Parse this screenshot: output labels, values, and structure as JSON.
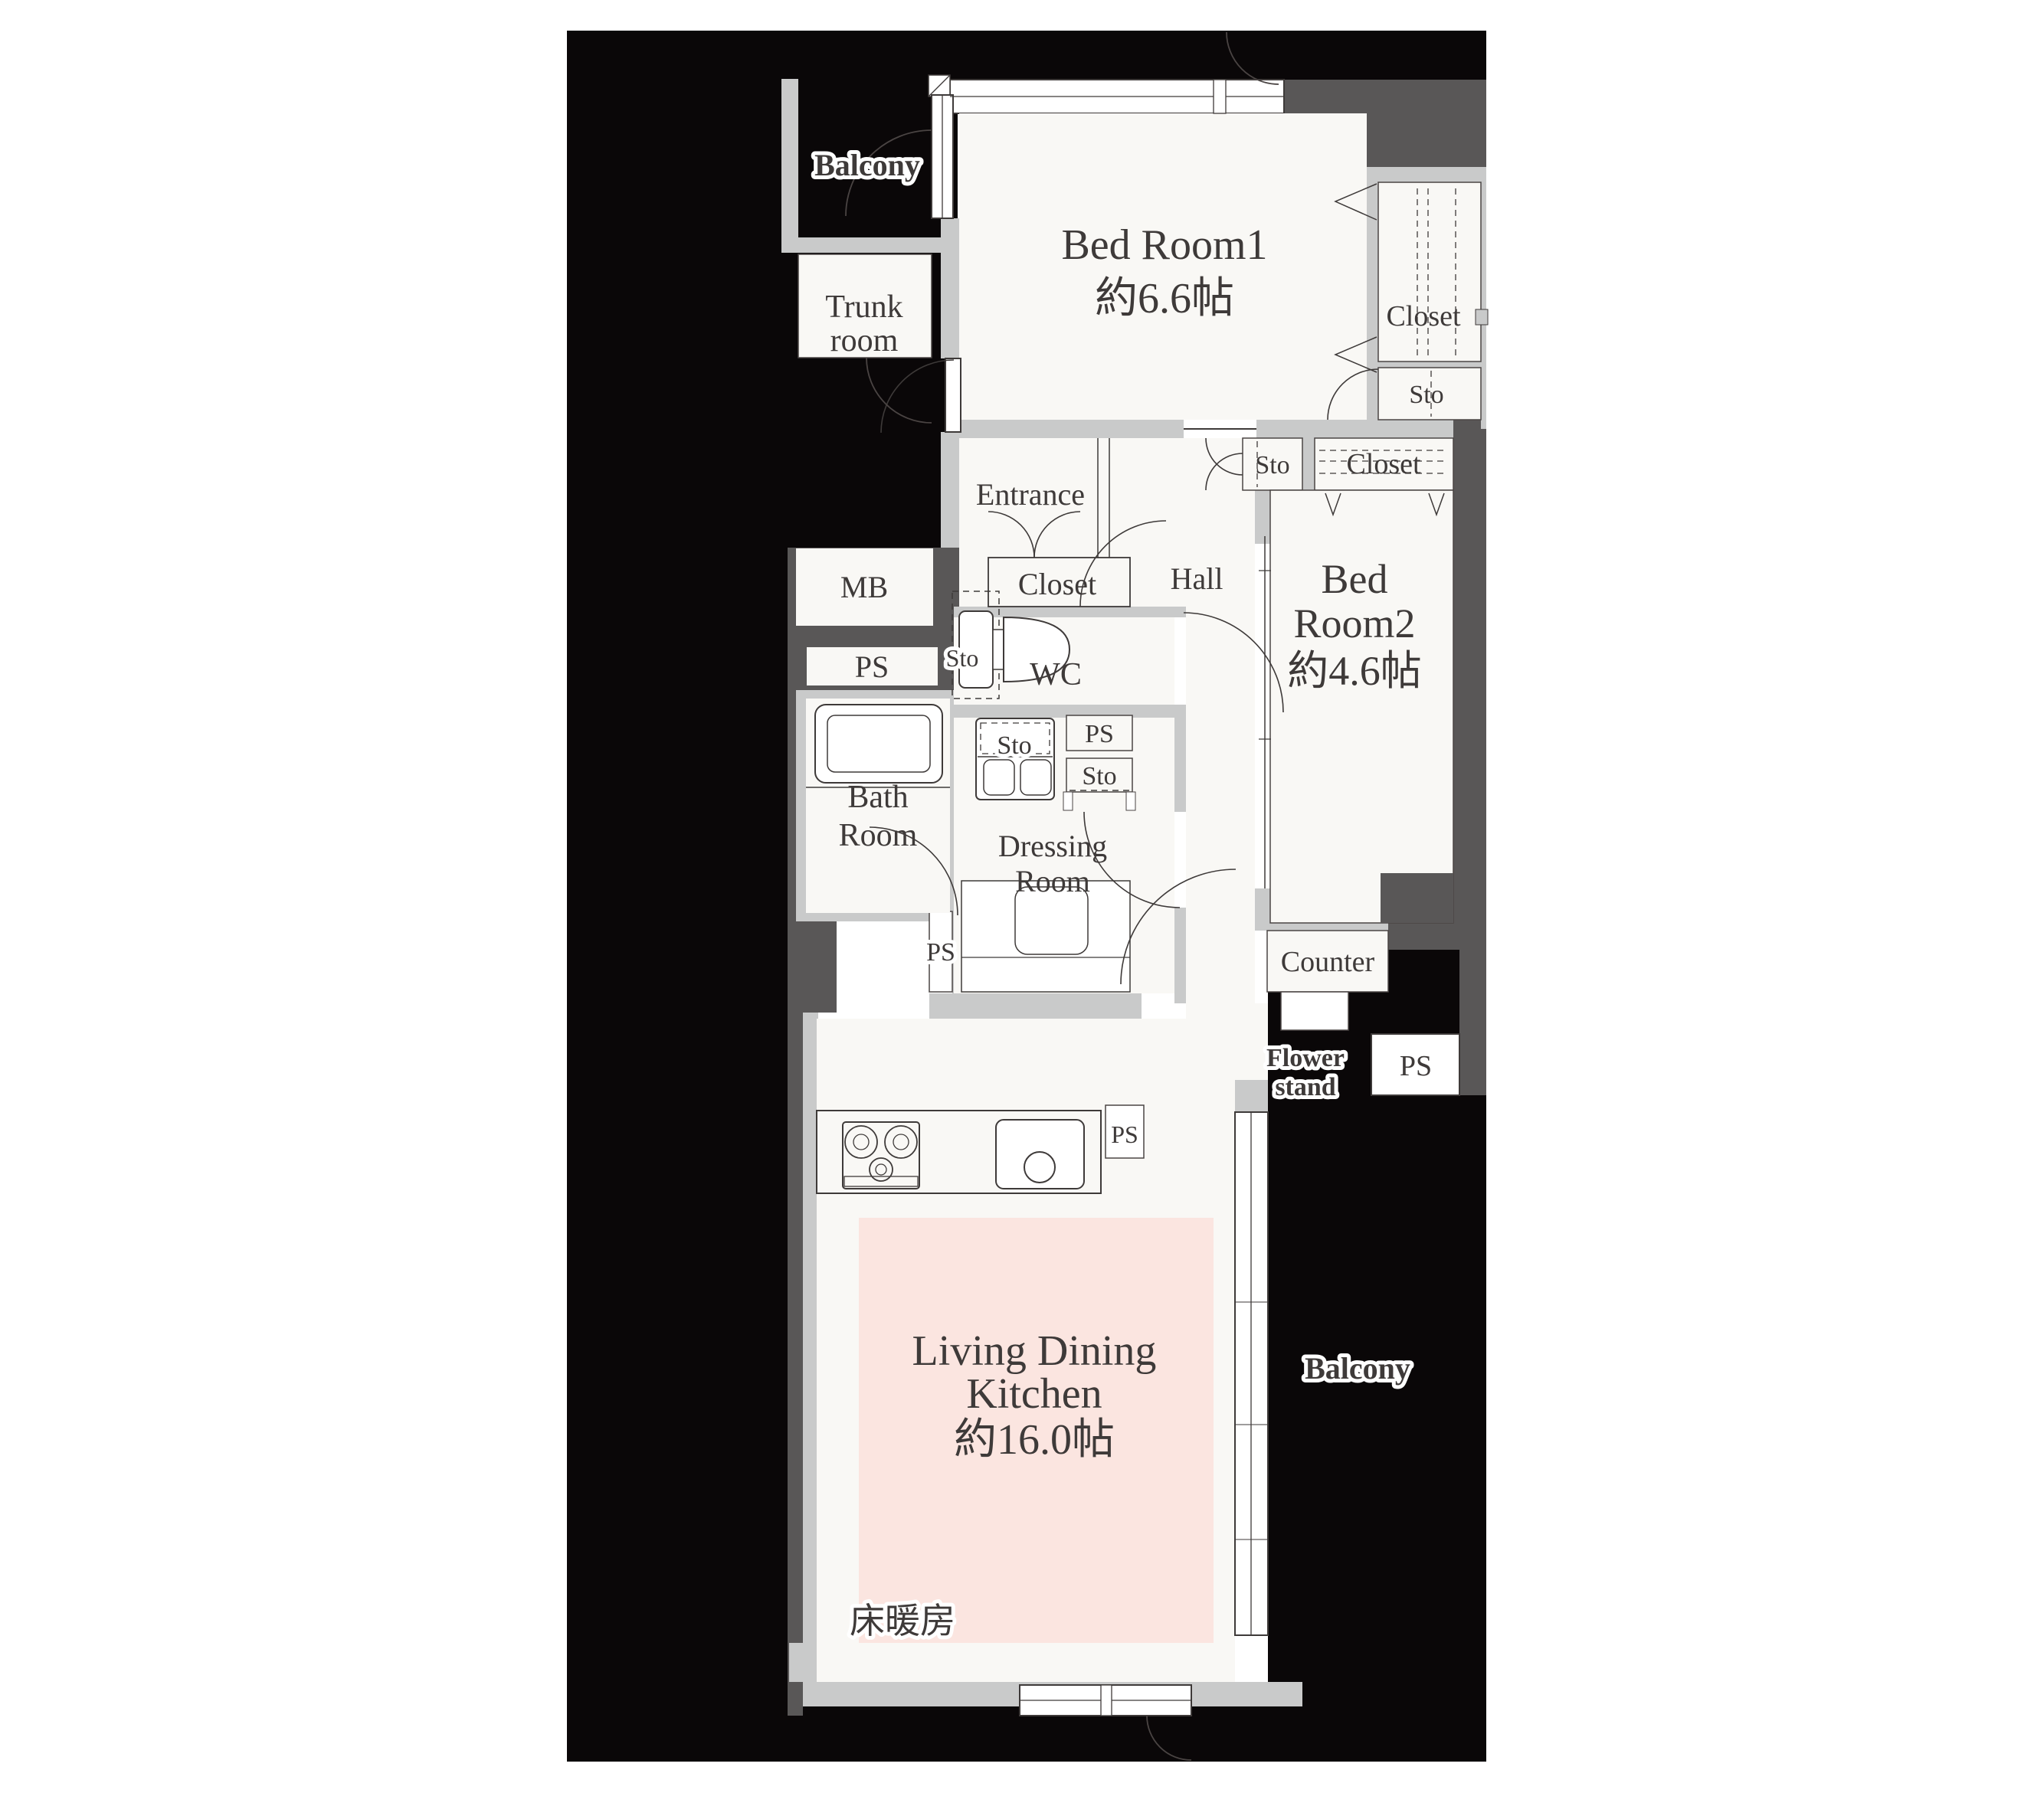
{
  "title": "apartment-floor-plan",
  "colors": {
    "background": "#ffffff",
    "exterior_black": "#0a0708",
    "wall_dark": "#595757",
    "wall_light": "#c9caca",
    "room_fill": "#f9f8f5",
    "floor_heating_pink": "#fbe5e0",
    "text": "#3e3a39"
  },
  "labels": {
    "balcony_top": "Balcony",
    "trunk_line1": "Trunk",
    "trunk_line2": "room",
    "bedroom1_name": "Bed Room1",
    "bedroom1_size": "約6.6帖",
    "closet_bedroom1": "Closet",
    "sto_bedroom1": "Sto",
    "entrance": "Entrance",
    "closet_entrance": "Closet",
    "hall": "Hall",
    "sto_hall": "Sto",
    "closet_bedroom2": "Closet",
    "bedroom2_line1": "Bed",
    "bedroom2_line2": "Room2",
    "bedroom2_size": "約4.6帖",
    "mb": "MB",
    "ps_left": "PS",
    "sto_wc": "Sto",
    "wc": "WC",
    "bath_line1": "Bath",
    "bath_line2": "Room",
    "sto_washer": "Sto",
    "ps_dressing": "PS",
    "sto_dressing": "Sto",
    "dressing_line1": "Dressing",
    "dressing_line2": "Room",
    "ps_bottom": "PS",
    "counter": "Counter",
    "flower_line1": "Flower",
    "flower_line2": "stand",
    "ps_balcony": "PS",
    "ps_kitchen": "PS",
    "ldk_line1": "Living Dining",
    "ldk_line2": "Kitchen",
    "ldk_size": "約16.0帖",
    "floor_heating": "床暖房",
    "balcony_bottom": "Balcony"
  }
}
